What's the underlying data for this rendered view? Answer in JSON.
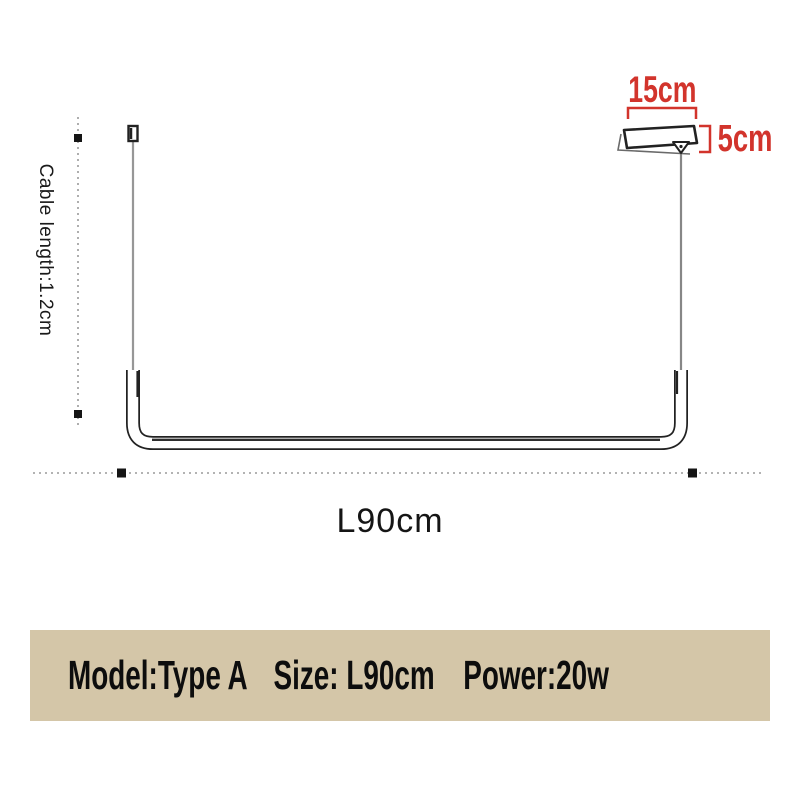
{
  "diagram": {
    "canopy_width_label": "15cm",
    "canopy_height_label": "5cm",
    "cable_length_label": "Cable length:1.2cm",
    "fixture_length_label": "L90cm"
  },
  "spec_banner": {
    "model": "Model:Type A",
    "size": "Size: L90cm",
    "power": "Power:20w"
  },
  "colors": {
    "dimension_red": "#d2342c",
    "banner_bg": "#d4c6a8",
    "line_dark": "#222222",
    "cable_gray": "#979797",
    "dot_gray": "#9a9a9a",
    "marker_black": "#151515"
  }
}
